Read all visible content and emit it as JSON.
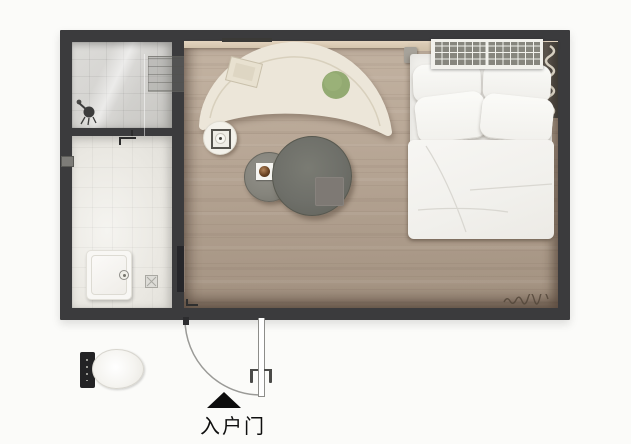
{
  "page": {
    "background": "#fbfbf9"
  },
  "floorplan": {
    "entrance": {
      "label": "入户门",
      "arrow": "up-triangle"
    },
    "rooms": {
      "shower_room": "shower room",
      "toilet_room": "toilet room",
      "main_room": "living bedroom"
    },
    "fixtures": [
      "shower-mixer",
      "wall-shelf",
      "glass-partition",
      "washbasin",
      "faucet",
      "toilet-bowl",
      "cistern",
      "floor-drain",
      "bath-door-handles",
      "pocket-door"
    ],
    "furniture": [
      "curved-sofa",
      "armrest-tray",
      "green-cushion",
      "round-side-table",
      "small-coffee-table",
      "coffee-cup",
      "large-coffee-table",
      "serving-tray",
      "double-bed",
      "pillows",
      "duvet",
      "bedside-shelf",
      "ac-radiator-unit",
      "hanging-coil-decor",
      "entry-door-leaf",
      "door-swing-arc",
      "floor-scribble-decor"
    ]
  },
  "colors": {
    "wall": "#3b3b3d",
    "wood_floor": "#b5a493",
    "shower_tile": "#d6d5d2",
    "bath_floor": "#ebe9e3",
    "ledge": "#dbcbb5",
    "sofa": "#ece6d9",
    "bed_linen": "#f3f2ee",
    "table_large": "#6e6f69",
    "table_small": "#85847c",
    "cushion_green": "#93aa72",
    "label_text": "#0f0f0f"
  }
}
